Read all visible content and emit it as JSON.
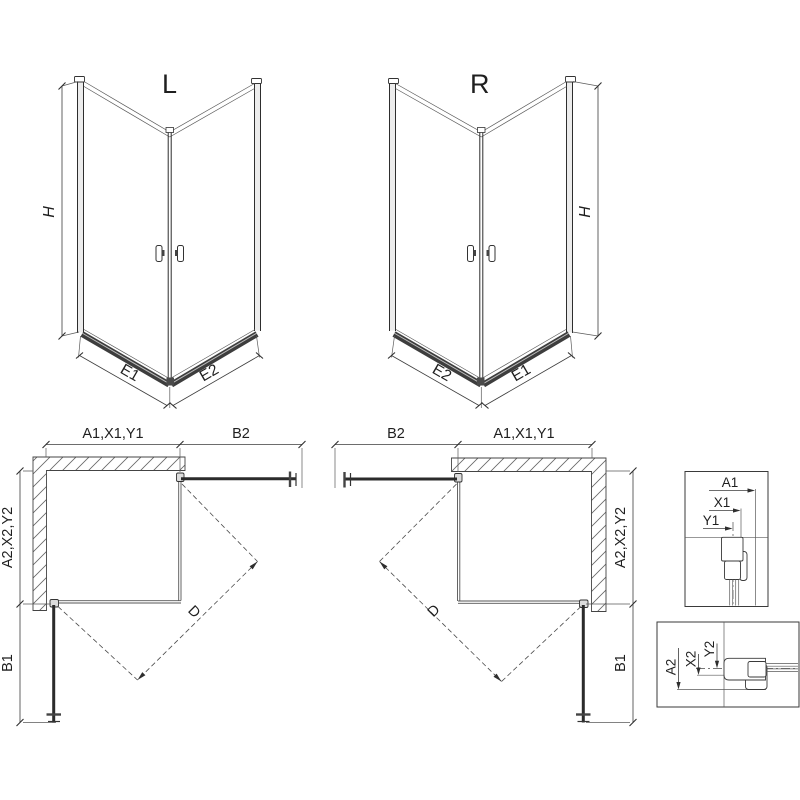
{
  "colors": {
    "line": "#2b2b2b",
    "background": "#ffffff",
    "hatch": "#666666"
  },
  "iso_left": {
    "title": "L",
    "height": "H",
    "width_left": "E1",
    "width_right": "E2"
  },
  "iso_right": {
    "title": "R",
    "height": "H",
    "width_left": "E2",
    "width_right": "E1"
  },
  "plan_left": {
    "top_dim": "A1,X1,Y1",
    "top_door_dim": "B2",
    "side_dim": "A2,X2,Y2",
    "side_door_dim": "B1",
    "diagonal_dim": "D"
  },
  "plan_right": {
    "top_door_dim": "B2",
    "top_dim": "A1,X1,Y1",
    "side_dim": "A2,X2,Y2",
    "side_door_dim": "B1",
    "diagonal_dim": "D"
  },
  "detail_wall_profile": {
    "dim_a": "A1",
    "dim_x": "X1",
    "dim_y": "Y1"
  },
  "detail_floor_profile": {
    "dim_a": "A2",
    "dim_x": "X2",
    "dim_y": "Y2"
  }
}
